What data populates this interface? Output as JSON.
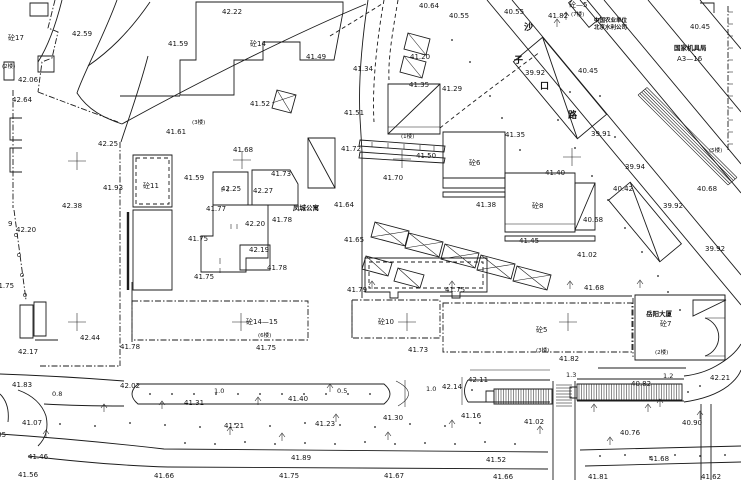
{
  "colors": {
    "bg": "#ffffff",
    "ink": "#1b1b1b",
    "label": "#141414"
  },
  "labels": [
    {
      "t": "42.22",
      "x": 222,
      "y": 14,
      "c": "e"
    },
    {
      "t": "42.59",
      "x": 72,
      "y": 36,
      "c": "e"
    },
    {
      "t": "砼17",
      "x": 8,
      "y": 40,
      "c": "b"
    },
    {
      "t": "41.59",
      "x": 168,
      "y": 46,
      "c": "e"
    },
    {
      "t": "砼14",
      "x": 250,
      "y": 46,
      "c": "b"
    },
    {
      "t": "(2楼)",
      "x": 2,
      "y": 68,
      "c": "f"
    },
    {
      "t": "42.06",
      "x": 18,
      "y": 82,
      "c": "e"
    },
    {
      "t": "42.64",
      "x": 12,
      "y": 102,
      "c": "e"
    },
    {
      "t": "41.52",
      "x": 250,
      "y": 106,
      "c": "e"
    },
    {
      "t": "41.49",
      "x": 306,
      "y": 59,
      "c": "e"
    },
    {
      "t": "(3楼)",
      "x": 192,
      "y": 124,
      "c": "f"
    },
    {
      "t": "41.61",
      "x": 166,
      "y": 134,
      "c": "e"
    },
    {
      "t": "42.25",
      "x": 98,
      "y": 146,
      "c": "e"
    },
    {
      "t": "41.93",
      "x": 103,
      "y": 190,
      "c": "e"
    },
    {
      "t": "砼11",
      "x": 143,
      "y": 188,
      "c": "b"
    },
    {
      "t": "42.38",
      "x": 62,
      "y": 208,
      "c": "e"
    },
    {
      "t": "9",
      "x": 8,
      "y": 226,
      "c": "e"
    },
    {
      "t": "42.20",
      "x": 16,
      "y": 232,
      "c": "e"
    },
    {
      "t": "41.59",
      "x": 184,
      "y": 180,
      "c": "e"
    },
    {
      "t": "41.68",
      "x": 233,
      "y": 152,
      "c": "e"
    },
    {
      "t": "41.73",
      "x": 271,
      "y": 176,
      "c": "e"
    },
    {
      "t": "42.25",
      "x": 221,
      "y": 191,
      "c": "e"
    },
    {
      "t": "42.27",
      "x": 253,
      "y": 193,
      "c": "e"
    },
    {
      "t": "41.77",
      "x": 206,
      "y": 211,
      "c": "e"
    },
    {
      "t": "42.20",
      "x": 245,
      "y": 226,
      "c": "e"
    },
    {
      "t": "41.78",
      "x": 272,
      "y": 222,
      "c": "e"
    },
    {
      "t": "41.75",
      "x": 188,
      "y": 241,
      "c": "e"
    },
    {
      "t": "42.19",
      "x": 249,
      "y": 252,
      "c": "e"
    },
    {
      "t": "41.78",
      "x": 267,
      "y": 270,
      "c": "e"
    },
    {
      "t": "41.75",
      "x": 194,
      "y": 279,
      "c": "e"
    },
    {
      "t": "凤城公寓",
      "x": 293,
      "y": 210,
      "c": "z"
    },
    {
      "t": "41.64",
      "x": 334,
      "y": 207,
      "c": "e"
    },
    {
      "t": "41.75",
      "x": -6,
      "y": 288,
      "c": "e"
    },
    {
      "t": "42.17",
      "x": 18,
      "y": 354,
      "c": "e"
    },
    {
      "t": "42.44",
      "x": 80,
      "y": 340,
      "c": "e"
    },
    {
      "t": "41.78",
      "x": 120,
      "y": 349,
      "c": "e"
    },
    {
      "t": "41.83",
      "x": 12,
      "y": 387,
      "c": "e"
    },
    {
      "t": "0.8",
      "x": 52,
      "y": 396,
      "c": "d"
    },
    {
      "t": "42.02",
      "x": 120,
      "y": 388,
      "c": "e"
    },
    {
      "t": "1.0",
      "x": 214,
      "y": 393,
      "c": "d"
    },
    {
      "t": "41.31",
      "x": 184,
      "y": 405,
      "c": "e"
    },
    {
      "t": "42.05",
      "x": -14,
      "y": 437,
      "c": "e"
    },
    {
      "t": "41.07",
      "x": 22,
      "y": 425,
      "c": "e"
    },
    {
      "t": "41.21",
      "x": 224,
      "y": 428,
      "c": "e"
    },
    {
      "t": "41.23",
      "x": 315,
      "y": 426,
      "c": "e"
    },
    {
      "t": "41.46",
      "x": 28,
      "y": 459,
      "c": "e"
    },
    {
      "t": "41.56",
      "x": 18,
      "y": 477,
      "c": "e"
    },
    {
      "t": "41.66",
      "x": 154,
      "y": 478,
      "c": "e"
    },
    {
      "t": "41.89",
      "x": 291,
      "y": 460,
      "c": "e"
    },
    {
      "t": "41.75",
      "x": 279,
      "y": 478,
      "c": "e"
    },
    {
      "t": "41.40",
      "x": 288,
      "y": 401,
      "c": "e"
    },
    {
      "t": "41.30",
      "x": 383,
      "y": 420,
      "c": "e"
    },
    {
      "t": "41.16",
      "x": 461,
      "y": 418,
      "c": "e"
    },
    {
      "t": "41.67",
      "x": 384,
      "y": 478,
      "c": "e"
    },
    {
      "t": "41.52",
      "x": 486,
      "y": 462,
      "c": "e"
    },
    {
      "t": "41.66",
      "x": 493,
      "y": 479,
      "c": "e"
    },
    {
      "t": "41.02",
      "x": 524,
      "y": 424,
      "c": "e"
    },
    {
      "t": "40.76",
      "x": 620,
      "y": 435,
      "c": "e"
    },
    {
      "t": "40.90",
      "x": 682,
      "y": 425,
      "c": "e"
    },
    {
      "t": "41.68",
      "x": 649,
      "y": 461,
      "c": "e"
    },
    {
      "t": "41.81",
      "x": 588,
      "y": 479,
      "c": "e"
    },
    {
      "t": "41.62",
      "x": 701,
      "y": 479,
      "c": "e"
    },
    {
      "t": "40.82",
      "x": 631,
      "y": 386,
      "c": "e"
    },
    {
      "t": "1.2",
      "x": 663,
      "y": 378,
      "c": "d"
    },
    {
      "t": "42.21",
      "x": 710,
      "y": 380,
      "c": "e"
    },
    {
      "t": "1.3",
      "x": 566,
      "y": 377,
      "c": "d"
    },
    {
      "t": "42.14",
      "x": 442,
      "y": 389,
      "c": "e"
    },
    {
      "t": "42.11",
      "x": 468,
      "y": 382,
      "c": "e"
    },
    {
      "t": "1.0",
      "x": 426,
      "y": 391,
      "c": "d"
    },
    {
      "t": "0.5",
      "x": 337,
      "y": 393,
      "c": "d"
    },
    {
      "t": "41.79",
      "x": 347,
      "y": 292,
      "c": "e"
    },
    {
      "t": "41.75",
      "x": 445,
      "y": 292,
      "c": "e"
    },
    {
      "t": "砼14—15",
      "x": 246,
      "y": 324,
      "c": "b"
    },
    {
      "t": "(6楼)",
      "x": 258,
      "y": 337,
      "c": "f"
    },
    {
      "t": "41.75",
      "x": 256,
      "y": 350,
      "c": "e"
    },
    {
      "t": "砼10",
      "x": 378,
      "y": 324,
      "c": "b"
    },
    {
      "t": "41.73",
      "x": 408,
      "y": 352,
      "c": "e"
    },
    {
      "t": "41.68",
      "x": 584,
      "y": 290,
      "c": "e"
    },
    {
      "t": "砼5",
      "x": 536,
      "y": 332,
      "c": "b"
    },
    {
      "t": "(3楼)",
      "x": 536,
      "y": 352,
      "c": "f"
    },
    {
      "t": "41.82",
      "x": 559,
      "y": 361,
      "c": "e"
    },
    {
      "t": "岳阳大厦",
      "x": 646,
      "y": 316,
      "c": "z"
    },
    {
      "t": "砼7",
      "x": 660,
      "y": 326,
      "c": "b"
    },
    {
      "t": "(2楼)",
      "x": 655,
      "y": 354,
      "c": "f"
    },
    {
      "t": "41.72",
      "x": 341,
      "y": 151,
      "c": "e"
    },
    {
      "t": "(1楼)",
      "x": 401,
      "y": 138,
      "c": "f"
    },
    {
      "t": "41.50",
      "x": 416,
      "y": 158,
      "c": "e"
    },
    {
      "t": "砼6",
      "x": 469,
      "y": 165,
      "c": "b"
    },
    {
      "t": "41.35",
      "x": 505,
      "y": 137,
      "c": "e"
    },
    {
      "t": "41.70",
      "x": 383,
      "y": 180,
      "c": "e"
    },
    {
      "t": "41.38",
      "x": 476,
      "y": 207,
      "c": "e"
    },
    {
      "t": "砼8",
      "x": 532,
      "y": 208,
      "c": "b"
    },
    {
      "t": "41.45",
      "x": 519,
      "y": 243,
      "c": "e"
    },
    {
      "t": "41.65",
      "x": 344,
      "y": 242,
      "c": "e"
    },
    {
      "t": "41.40",
      "x": 545,
      "y": 175,
      "c": "e"
    },
    {
      "t": "41.02",
      "x": 577,
      "y": 257,
      "c": "e"
    },
    {
      "t": "40.68",
      "x": 583,
      "y": 222,
      "c": "e"
    },
    {
      "t": "40.42",
      "x": 613,
      "y": 191,
      "c": "e"
    },
    {
      "t": "39.94",
      "x": 625,
      "y": 169,
      "c": "e"
    },
    {
      "t": "39.92",
      "x": 663,
      "y": 208,
      "c": "e"
    },
    {
      "t": "39.92",
      "x": 705,
      "y": 251,
      "c": "e"
    },
    {
      "t": "39.91",
      "x": 591,
      "y": 136,
      "c": "e"
    },
    {
      "t": "(5楼)",
      "x": 709,
      "y": 152,
      "c": "f"
    },
    {
      "t": "40.68",
      "x": 697,
      "y": 191,
      "c": "e"
    },
    {
      "t": "41.34",
      "x": 353,
      "y": 71,
      "c": "e"
    },
    {
      "t": "41.51",
      "x": 344,
      "y": 115,
      "c": "e"
    },
    {
      "t": "41.20",
      "x": 410,
      "y": 59,
      "c": "e"
    },
    {
      "t": "41.35",
      "x": 409,
      "y": 87,
      "c": "e"
    },
    {
      "t": "41.29",
      "x": 442,
      "y": 91,
      "c": "e"
    },
    {
      "t": "40.64",
      "x": 419,
      "y": 8,
      "c": "e"
    },
    {
      "t": "40.55",
      "x": 449,
      "y": 18,
      "c": "e"
    },
    {
      "t": "40.55",
      "x": 504,
      "y": 14,
      "c": "e"
    },
    {
      "t": "41.82",
      "x": 548,
      "y": 18,
      "c": "e"
    },
    {
      "t": "砼—5",
      "x": 569,
      "y": 7,
      "c": "b"
    },
    {
      "t": "(7楼)",
      "x": 571,
      "y": 16,
      "c": "f"
    },
    {
      "t": "中国农业单位",
      "x": 594,
      "y": 22,
      "c": "n"
    },
    {
      "t": "北京水利公司",
      "x": 594,
      "y": 29,
      "c": "n"
    },
    {
      "t": "国家机具局",
      "x": 674,
      "y": 50,
      "c": "z"
    },
    {
      "t": "A3—16",
      "x": 677,
      "y": 61,
      "c": "e"
    },
    {
      "t": "40.45",
      "x": 578,
      "y": 73,
      "c": "e"
    },
    {
      "t": "40.45",
      "x": 690,
      "y": 29,
      "c": "e"
    },
    {
      "t": "39.92",
      "x": 525,
      "y": 75,
      "c": "e"
    },
    {
      "t": "沙",
      "x": 524,
      "y": 30,
      "c": "s"
    },
    {
      "t": "子",
      "x": 514,
      "y": 63,
      "c": "s"
    },
    {
      "t": "口",
      "x": 540,
      "y": 89,
      "c": "s"
    },
    {
      "t": "路",
      "x": 568,
      "y": 118,
      "c": "s"
    }
  ],
  "grid_crosses": [
    [
      77,
      161
    ],
    [
      242,
      160
    ],
    [
      402,
      159
    ],
    [
      572,
      157
    ],
    [
      77,
      322
    ],
    [
      241,
      322
    ],
    [
      407,
      322
    ],
    [
      568,
      322
    ]
  ],
  "trees": [
    [
      104,
      412
    ],
    [
      162,
      409
    ],
    [
      258,
      405
    ],
    [
      230,
      435
    ],
    [
      282,
      441
    ],
    [
      336,
      422
    ],
    [
      388,
      440
    ],
    [
      452,
      428
    ],
    [
      540,
      434
    ],
    [
      610,
      445
    ],
    [
      660,
      407
    ],
    [
      700,
      419
    ],
    [
      46,
      438
    ],
    [
      372,
      289
    ],
    [
      452,
      289
    ],
    [
      570,
      289
    ],
    [
      640,
      288
    ],
    [
      557,
      27
    ],
    [
      566,
      20
    ],
    [
      594,
      412
    ],
    [
      648,
      412
    ],
    [
      330,
      392
    ]
  ],
  "point_dots": [
    [
      150,
      394
    ],
    [
      172,
      394
    ],
    [
      194,
      394
    ],
    [
      216,
      394
    ],
    [
      238,
      394
    ],
    [
      260,
      394
    ],
    [
      282,
      394
    ],
    [
      304,
      394
    ],
    [
      326,
      394
    ],
    [
      348,
      394
    ],
    [
      370,
      394
    ],
    [
      60,
      424
    ],
    [
      95,
      426
    ],
    [
      130,
      423
    ],
    [
      165,
      425
    ],
    [
      200,
      427
    ],
    [
      235,
      424
    ],
    [
      270,
      426
    ],
    [
      305,
      423
    ],
    [
      340,
      425
    ],
    [
      375,
      427
    ],
    [
      410,
      424
    ],
    [
      445,
      426
    ],
    [
      480,
      423
    ],
    [
      185,
      443
    ],
    [
      215,
      444
    ],
    [
      245,
      442
    ],
    [
      275,
      444
    ],
    [
      305,
      443
    ],
    [
      335,
      444
    ],
    [
      365,
      442
    ],
    [
      395,
      444
    ],
    [
      425,
      443
    ],
    [
      455,
      444
    ],
    [
      485,
      442
    ],
    [
      515,
      444
    ],
    [
      600,
      456
    ],
    [
      625,
      455
    ],
    [
      650,
      457
    ],
    [
      675,
      455
    ],
    [
      700,
      456
    ],
    [
      725,
      455
    ],
    [
      558,
      120
    ],
    [
      575,
      148
    ],
    [
      592,
      176
    ],
    [
      608,
      200
    ],
    [
      625,
      228
    ],
    [
      642,
      252
    ],
    [
      658,
      276
    ],
    [
      600,
      96
    ],
    [
      570,
      92
    ],
    [
      615,
      137
    ],
    [
      668,
      292
    ],
    [
      680,
      310
    ],
    [
      472,
      390
    ],
    [
      688,
      392
    ],
    [
      700,
      386
    ],
    [
      452,
      40
    ],
    [
      470,
      62
    ],
    [
      490,
      96
    ],
    [
      502,
      118
    ],
    [
      520,
      150
    ]
  ],
  "fence_posts": [
    [
      16,
      235
    ],
    [
      19,
      255
    ],
    [
      22,
      275
    ],
    [
      25,
      295
    ]
  ]
}
